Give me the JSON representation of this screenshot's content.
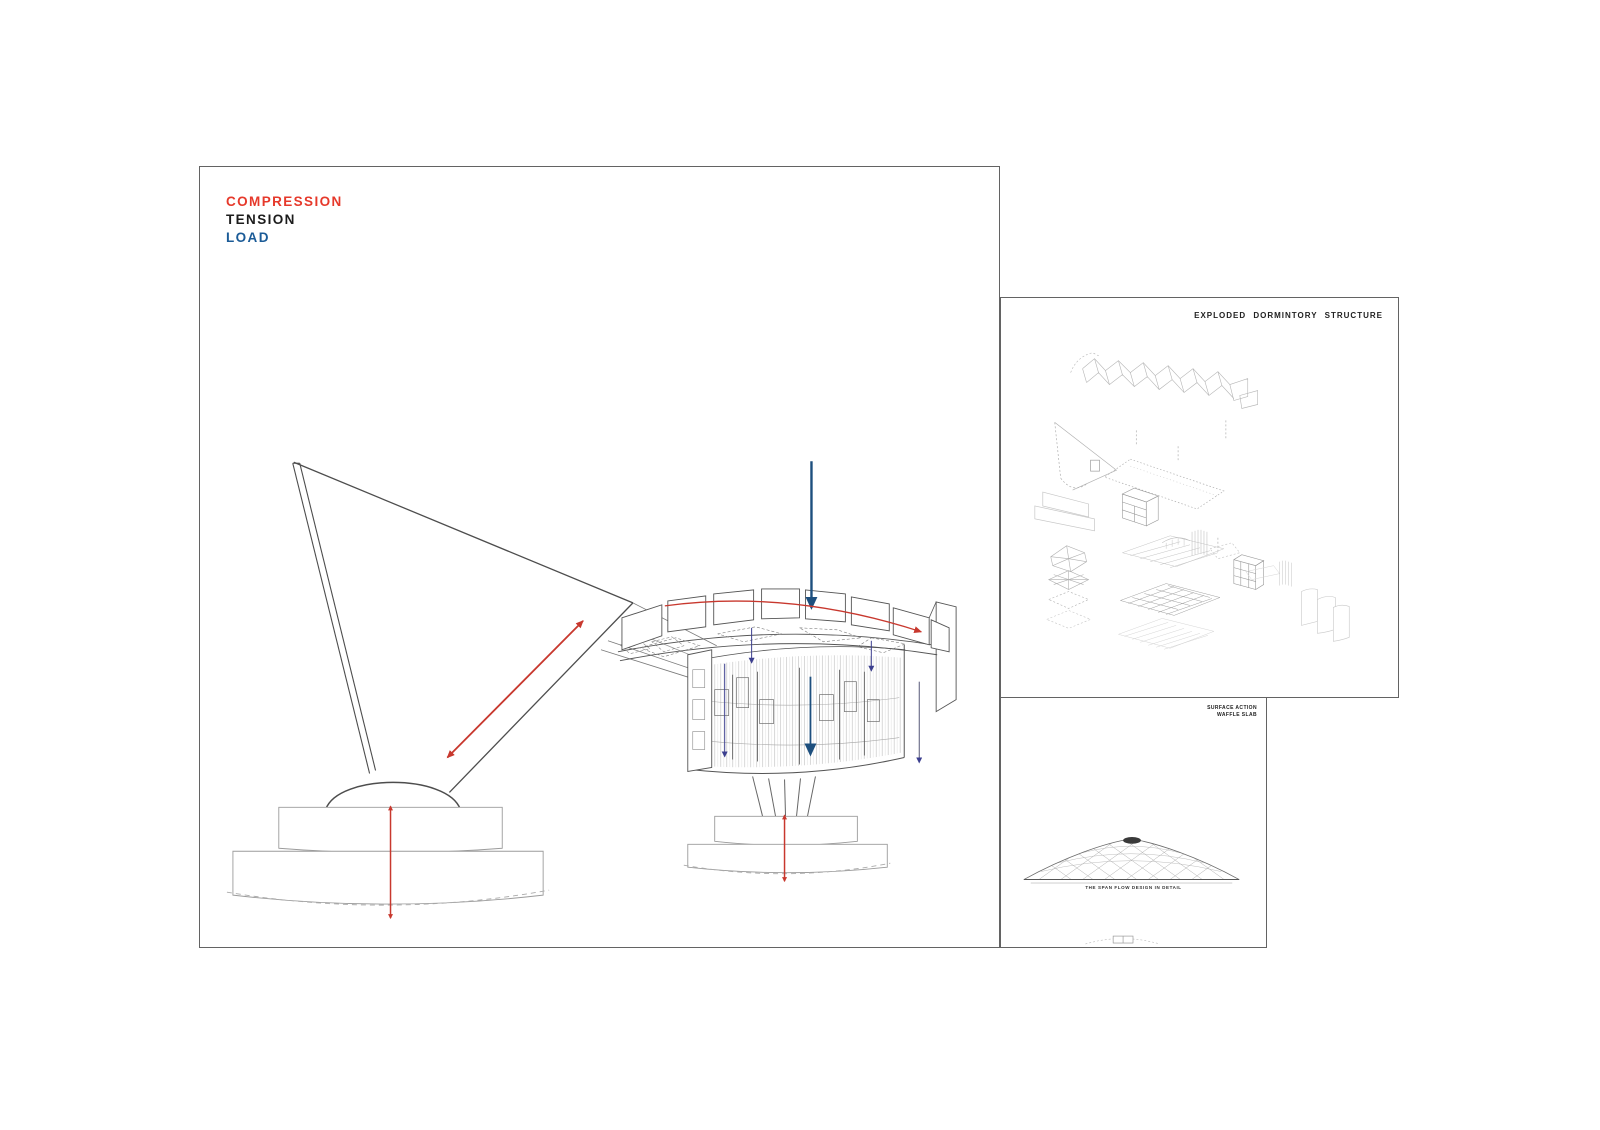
{
  "main_panel": {
    "legend": {
      "items": [
        {
          "label": "COMPRESSION",
          "color": "#e6392b"
        },
        {
          "label": "TENSION",
          "color": "#1c1c1c"
        },
        {
          "label": "LOAD",
          "color": "#1b5b97"
        }
      ]
    }
  },
  "exploded_panel": {
    "title": "EXPLODED DORMINTORY STRUCTURE"
  },
  "waffle_panel": {
    "caption_line1": "SURFACE ACTION",
    "caption_line2": "WAFFLE SLAB",
    "footnote": "THE SPAN FLOW DESIGN IN DETAIL"
  },
  "colors": {
    "compression_red": "#c8382e",
    "tension_black": "#1c1c1c",
    "load_blue": "#1d4f7e",
    "panel_border": "#636363"
  }
}
